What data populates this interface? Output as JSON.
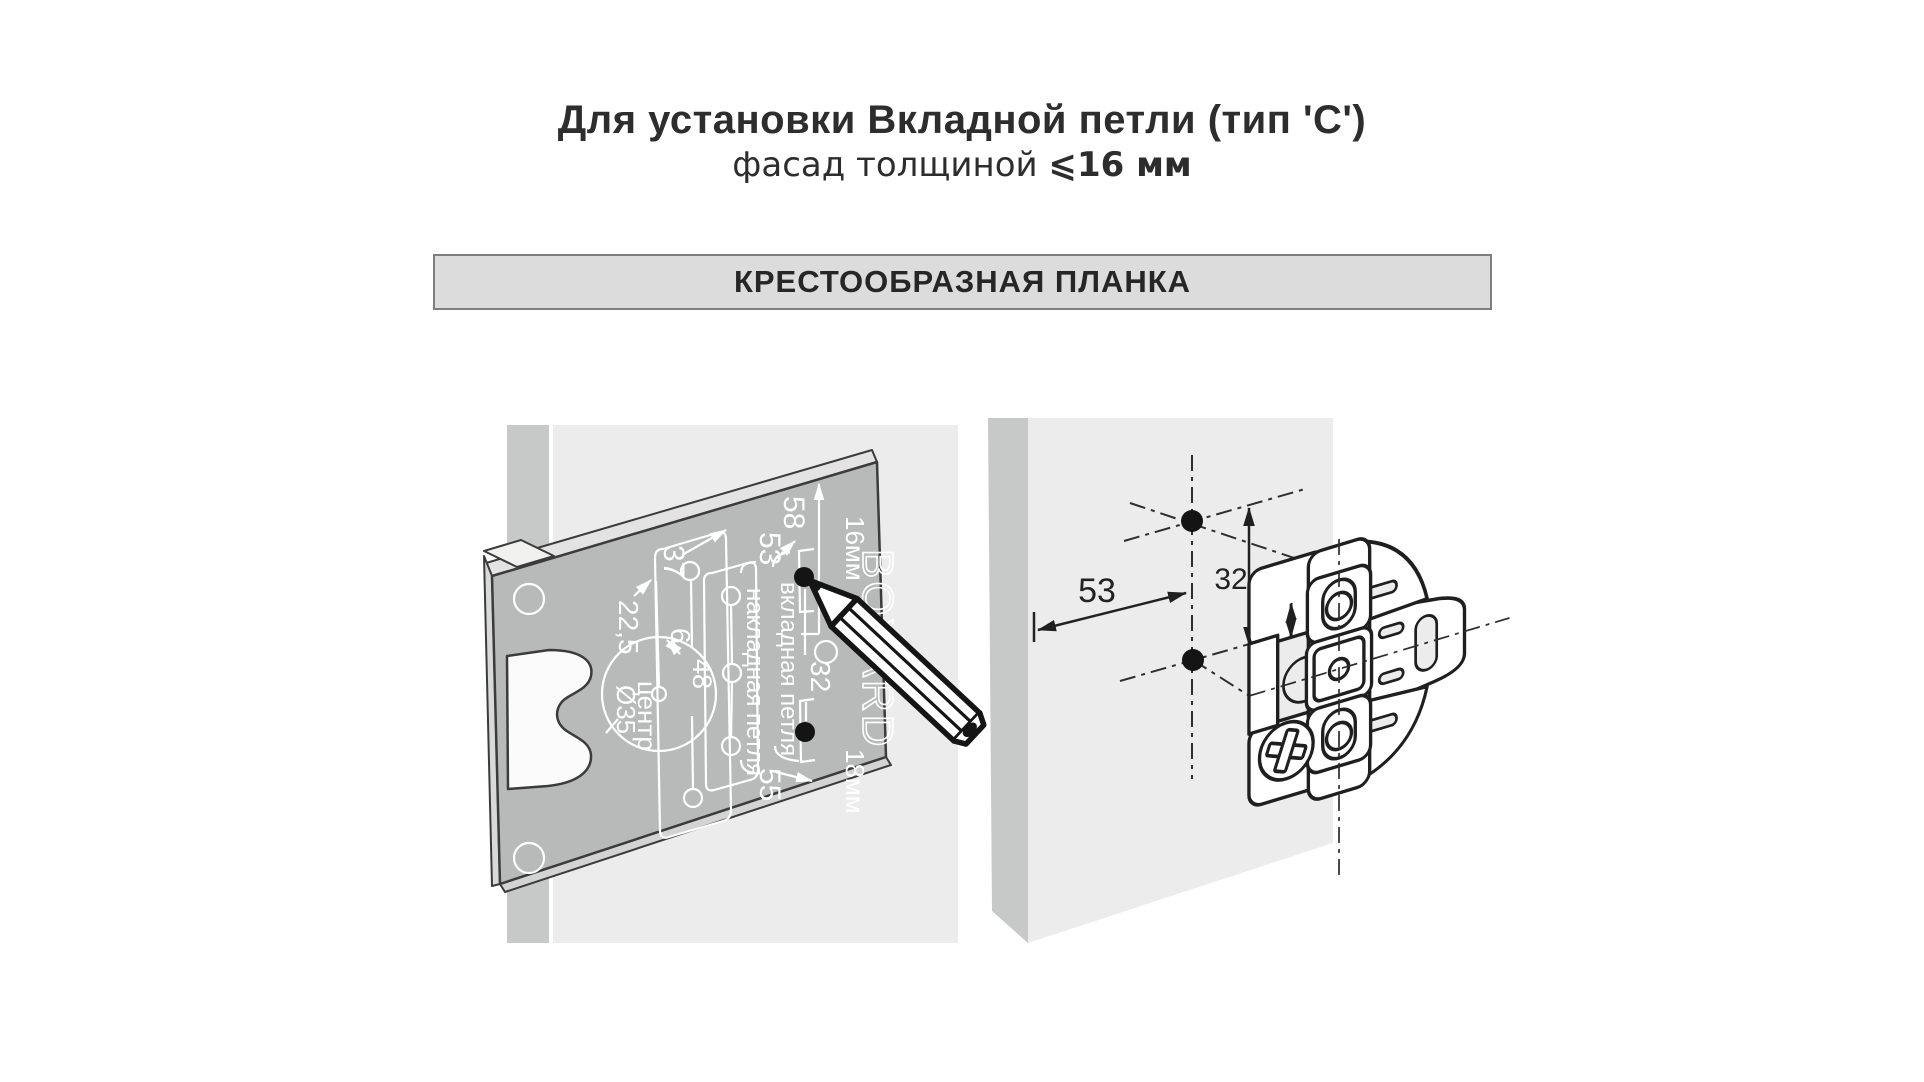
{
  "title": {
    "line1": "Для установки Вкладной петли (тип 'C')",
    "thickness_prefix": "фасад толщиной ",
    "thickness_value": "⩽16 мм"
  },
  "banner": {
    "label": "КРЕСТООБРАЗНАЯ ПЛАНКА"
  },
  "colors": {
    "banner_bg": "#dcdcdc",
    "banner_border": "#7e7e7e",
    "panel_light": "#ececec",
    "panel_mid": "#c7c9c8",
    "template_gray": "#b8bab9",
    "outline_dark": "#3b3b3b",
    "engraving": "#ffffff",
    "dimension_dark": "#222222"
  },
  "template_diagram": {
    "labels": {
      "edge_58": "58",
      "edge_53": "53",
      "offset_37": "37",
      "offset_22_5": "22,5",
      "offset_6": "6",
      "spacing_48": "48",
      "spacing_32": "32",
      "edge_55": "55",
      "cup_center_line1": "центр",
      "cup_center_line2": "Ø35",
      "column_inset": "вкладная петля",
      "column_overlay": "накладная петля",
      "facade_16": "16мм",
      "facade_18": "18мм",
      "brand": "BOYARD"
    }
  },
  "marking_diagram": {
    "labels": {
      "dim_53": "53",
      "dim_32": "32"
    }
  }
}
